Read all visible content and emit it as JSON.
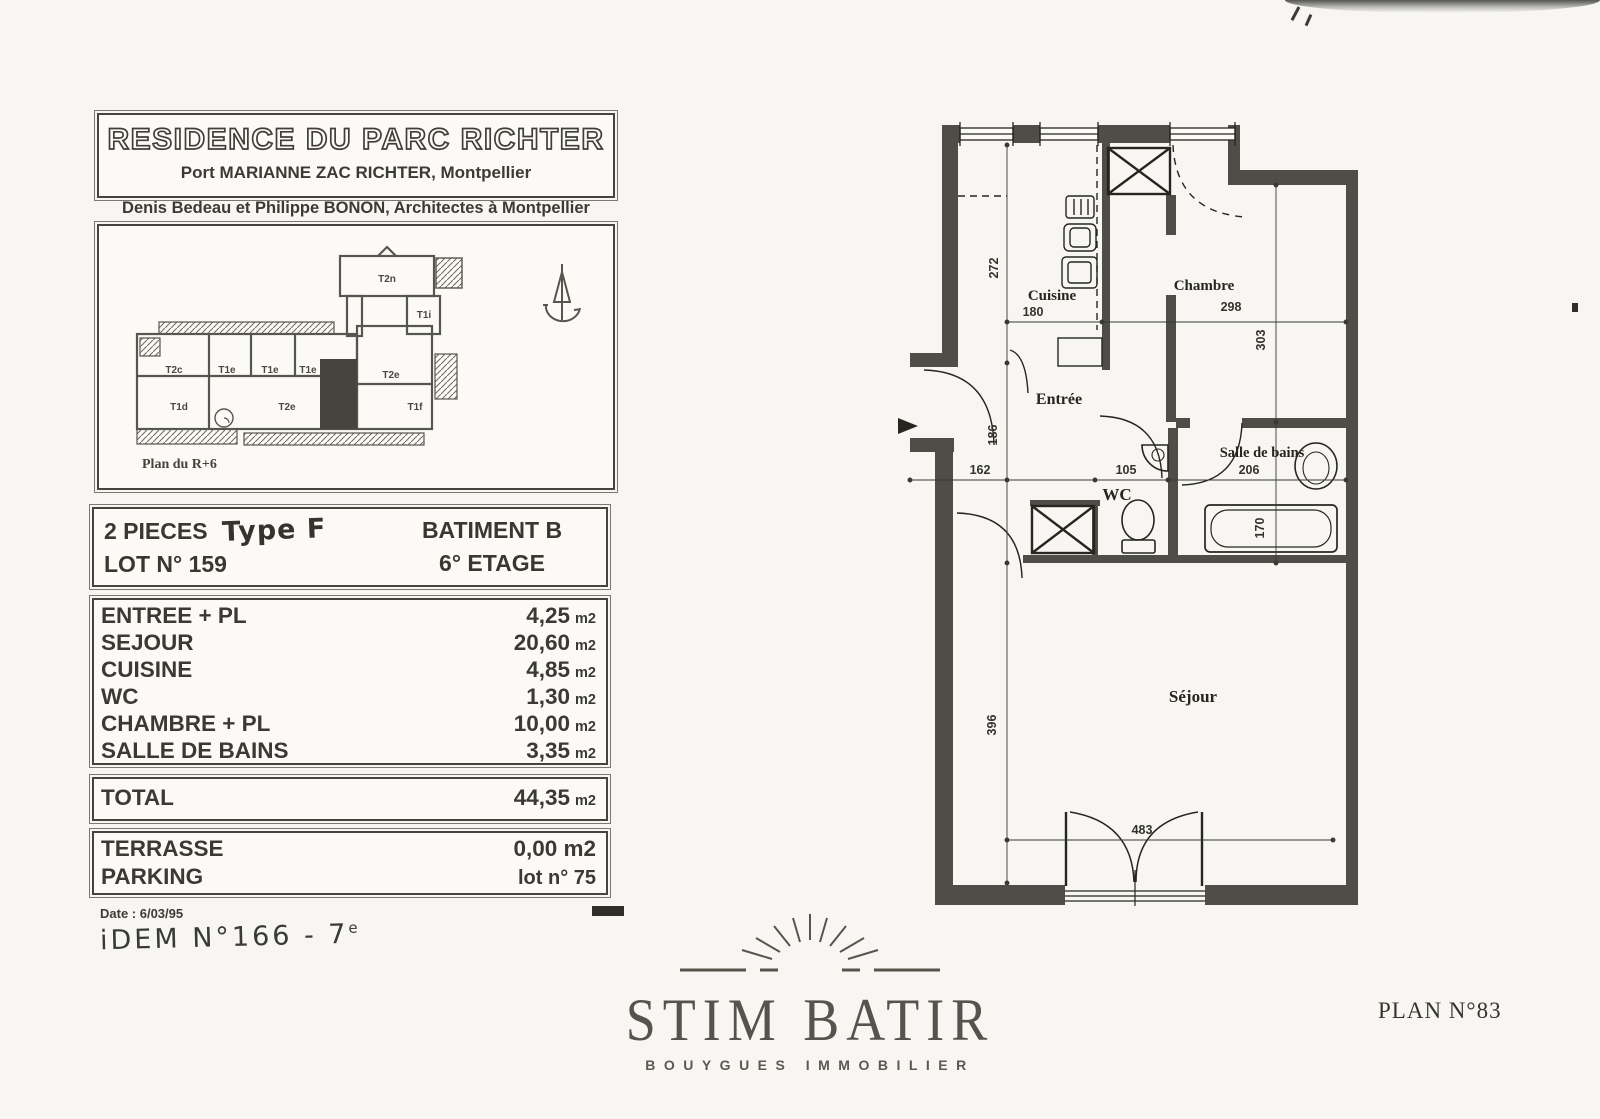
{
  "header": {
    "title": "RESIDENCE DU PARC RICHTER",
    "subtitle": "Port MARIANNE ZAC RICHTER, Montpellier",
    "architects": "Denis Bedeau et Philippe BONON,  Architectes à Montpellier"
  },
  "overview": {
    "caption": "Plan du R+6",
    "units": {
      "t2n": "T2n",
      "t1i": "T1i",
      "t2c": "T2c",
      "t1e1": "T1e",
      "t1e2": "T1e",
      "t1e3": "T1e",
      "t2e_right": "T2e",
      "t1f": "T1f",
      "t1d": "T1d",
      "t2e_bottom": "T2e"
    }
  },
  "lot": {
    "type_line": "2 PIECES",
    "type_hand": "Type F",
    "lot_line": "LOT N° 159",
    "batiment": "BATIMENT  B",
    "etage": "6° ETAGE"
  },
  "areas": {
    "unit": "m2",
    "rows": [
      {
        "label": "ENTREE + PL",
        "value": "4,25"
      },
      {
        "label": "SEJOUR",
        "value": "20,60"
      },
      {
        "label": "CUISINE",
        "value": "4,85"
      },
      {
        "label": "WC",
        "value": "1,30"
      },
      {
        "label": "CHAMBRE + PL",
        "value": "10,00"
      },
      {
        "label": "SALLE DE BAINS",
        "value": "3,35"
      }
    ]
  },
  "total": {
    "label": "TOTAL",
    "value": "44,35",
    "unit": "m2"
  },
  "annex": {
    "rows": [
      {
        "label": "TERRASSE",
        "value": "0,00 m2"
      },
      {
        "label": "PARKING",
        "value": "lot n° 75"
      }
    ]
  },
  "notes": {
    "date": "Date :  6/03/95",
    "hand_main": "iDEM   N°166  -  7",
    "hand_sup": "e"
  },
  "logo": {
    "name": "STIM BATIR",
    "tagline": "BOUYGUES IMMOBILIER"
  },
  "plan_number": "PLAN N°83",
  "floorplan": {
    "rooms": {
      "cuisine": "Cuisine",
      "chambre": "Chambre",
      "entree": "Entrée",
      "salle_de_bains": "Salle de bains",
      "wc": "WC",
      "sejour": "Séjour"
    },
    "dims": {
      "v272": "272",
      "h180": "180",
      "h298": "298",
      "v303": "303",
      "v186": "186",
      "h162": "162",
      "h105": "105",
      "h206": "206",
      "v170": "170",
      "v396": "396",
      "h483": "483"
    },
    "colors": {
      "wall": "#4e4d48",
      "ink": "#26261f"
    }
  }
}
